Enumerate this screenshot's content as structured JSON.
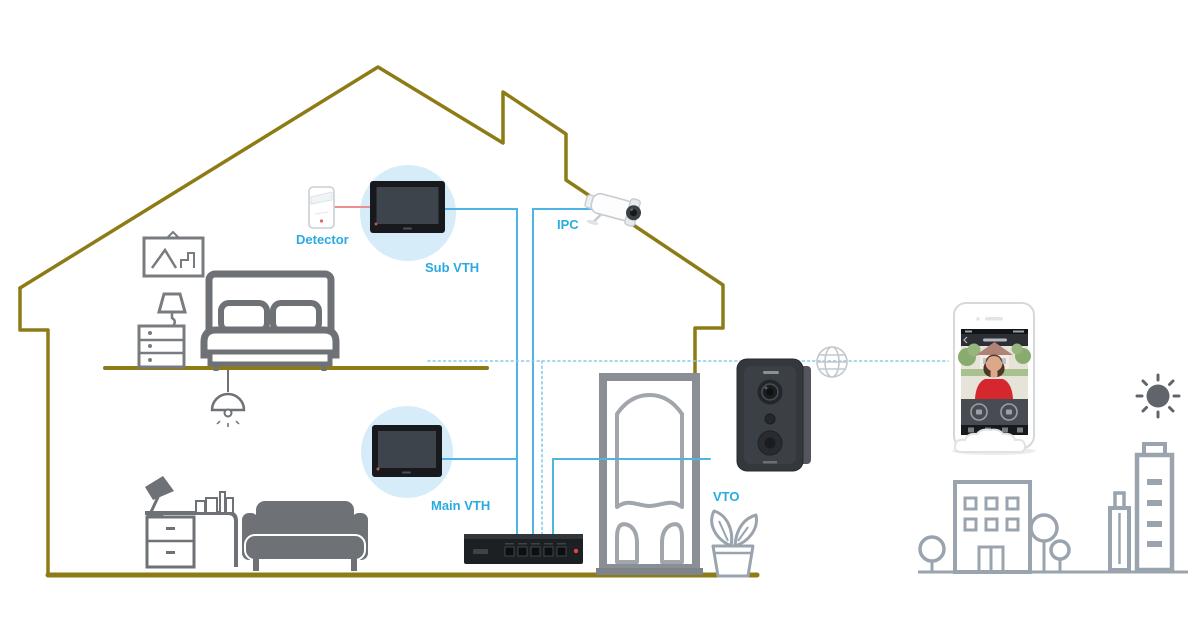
{
  "diagram": {
    "type": "smart-home-intercom-wiring-diagram",
    "labels": {
      "detector": "Detector",
      "sub_vth": "Sub VTH",
      "ipc": "IPC",
      "main_vth": "Main VTH",
      "vto": "VTO"
    },
    "devices": [
      {
        "id": "detector",
        "label": "Detector",
        "kind": "motion-detector"
      },
      {
        "id": "sub-vth",
        "label": "Sub VTH",
        "kind": "indoor-monitor"
      },
      {
        "id": "ipc",
        "label": "IPC",
        "kind": "bullet-network-camera"
      },
      {
        "id": "main-vth",
        "label": "Main VTH",
        "kind": "indoor-monitor"
      },
      {
        "id": "switch",
        "label": "",
        "kind": "network-switch"
      },
      {
        "id": "vto",
        "label": "VTO",
        "kind": "door-station"
      },
      {
        "id": "smartphone",
        "label": "",
        "kind": "mobile-app-phone"
      }
    ],
    "connections": [
      {
        "from": "detector",
        "to": "sub-vth",
        "style": "solid",
        "color": "#ea8f8f"
      },
      {
        "from": "sub-vth",
        "to": "switch",
        "style": "solid",
        "color": "#4fb4e4"
      },
      {
        "from": "ipc",
        "to": "switch",
        "style": "solid",
        "color": "#4fb4e4"
      },
      {
        "from": "main-vth",
        "to": "switch",
        "style": "solid",
        "color": "#4fb4e4"
      },
      {
        "from": "vto",
        "to": "switch",
        "style": "solid",
        "color": "#4fb4e4"
      },
      {
        "from": "switch",
        "to": "smartphone",
        "style": "dashed",
        "via": "internet-globe",
        "color": "#86ccee"
      }
    ],
    "scenery": [
      "house-outline",
      "bedroom-furniture",
      "living-room-furniture",
      "front-door",
      "potted-plant",
      "internet-globe-icon",
      "sun-icon",
      "cloud",
      "city-buildings",
      "trees"
    ],
    "colors": {
      "house_outline": "#8d7c15",
      "connection_line": "#4fb4e4",
      "dashed_line": "#86ccee",
      "alarm_line": "#ea8f8f",
      "label_text": "#29abe2",
      "device_halo": "#d6ecf9",
      "furniture_gray": "#6e7276",
      "city_gray": "#9aa4ae",
      "device_dark": "#1d2023",
      "led_red": "#e8413c"
    }
  }
}
